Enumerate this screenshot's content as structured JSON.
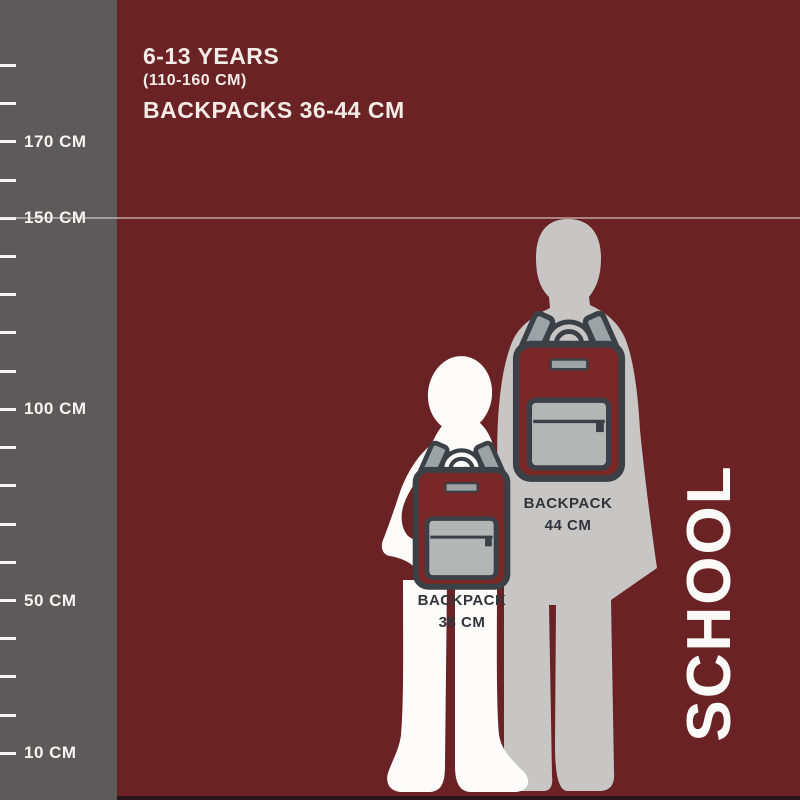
{
  "header": {
    "age_range": "6-13 YEARS",
    "height_range": "(110-160 CM)",
    "backpack_range": "BACKPACKS 36-44 CM"
  },
  "ruler": {
    "unit": "CM",
    "min_cm": 10,
    "max_cm": 190,
    "step_cm": 10,
    "labeled_marks": [
      170,
      150,
      100,
      50,
      10
    ],
    "label_suffix": " CM"
  },
  "reference_line_cm": 150,
  "figures": [
    {
      "name": "older child silhouette",
      "backpack": {
        "label": "BACKPACK",
        "size": "44 CM"
      }
    },
    {
      "name": "younger child silhouette",
      "backpack": {
        "label": "BACKPACK",
        "size": "38 CM"
      }
    }
  ],
  "side_text": "SCHOOL",
  "colors": {
    "background": "#6b2224",
    "ruler": "#5c5a5b",
    "ruler_marks": "#f7f3f0",
    "header_text": "#f2ebe6",
    "older_child": "#c7c6c4",
    "younger_child": "#fdfcfa",
    "backpack_body": "#7a2827",
    "backpack_outline": "#3a4046",
    "backpack_pocket": "#b4b6b6",
    "backpack_strap": "#9da2a5",
    "label_text": "#2f353b",
    "side_text_color": "#fbfaf8",
    "bottom_bar": "#2a1517"
  }
}
